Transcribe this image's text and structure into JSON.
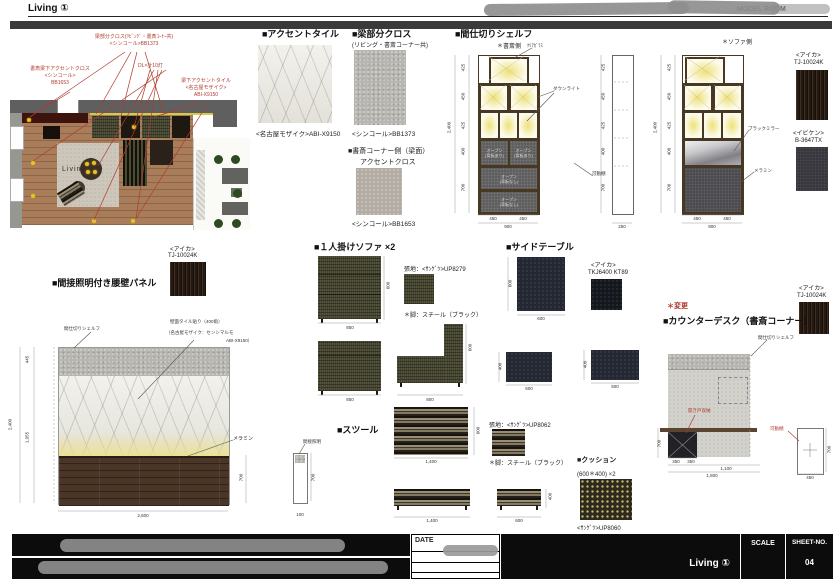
{
  "header": {
    "title": "Living ①",
    "redacted_text": "MODEL ROOM"
  },
  "plan": {
    "room": "Living",
    "ann_beam1": "梁部分クロス(ﾘﾋﾞﾝｸﾞ・書斎ｺｰﾅｰ共)",
    "ann_beam2": "<シンコール>BB1373",
    "ann_dl": "DL×計10灯",
    "ann_study1": "書斎梁下アクセントクロス",
    "ann_study2": "<シンコール>",
    "ann_study3": "BB1653",
    "ann_tile1": "梁下アクセントタイル",
    "ann_tile2": "<名古屋モザイク>",
    "ann_tile3": "ABI-X9150"
  },
  "samples": {
    "accent_tile_title": "■アクセントタイル",
    "accent_tile_caption": "<名古屋モザイク>ABI-X9150",
    "beam_title": "■梁部分クロス",
    "beam_subtitle": "(リビング・書斎コーナー共)",
    "beam_caption": "<シンコール>BB1373",
    "study_title1": "■書斎コーナー側（梁面）",
    "study_title2": "アクセントクロス",
    "study_caption": "<シンコール>BB1653"
  },
  "materials": {
    "aica": "<アイカ>",
    "aica_code": "TJ-10024K",
    "ibiken": "<イビケン>",
    "ibiken_code": "B-3647TX",
    "aica2_code": "TKJ6400 KT89",
    "sangetsu_sofa": "張地：<ｻﾝｹﾞﾂ>UP8279",
    "sangetsu_stool": "張地：<ｻﾝｹﾞﾂ>UP8062",
    "sangetsu_cushion": "<ｻﾝｹﾞﾂ>UP8060",
    "legs": "＊脚：スチール（ブラック）"
  },
  "shelf": {
    "title": "■間仕切りシェルフ",
    "study_side": "＊書斎側",
    "sofa_side": "＊ソファ側",
    "ann_glass": "ｸﾘｱｶﾞﾗｽ",
    "ann_downlight": "ダウンライト",
    "ann_movable": "可動棚",
    "ann_mirror": "ブラックミラー",
    "ann_melamine": "メラミン",
    "open": "オープン",
    "open_back": "(背板あり)",
    "open_noback": "(背板なし)",
    "h_total": "2,400",
    "h1": "425",
    "h2": "450",
    "h3": "425",
    "h4": "400",
    "h5": "700",
    "w1": "450",
    "w2": "450",
    "w_total": "900",
    "side_w": "250"
  },
  "panel": {
    "title": "■間接照明付き腰壁パネル",
    "ann_shelf": "間仕切りシェルフ",
    "ann_tile1": "壁面タイル貼り（400角）",
    "ann_tile2": "（名古屋モザイク：センシマルモ",
    "ann_tile3": "ABI-X9150）",
    "ann_melamine": "メラミン",
    "ann_light": "間接照明",
    "h_total": "2,400",
    "h_top": "445",
    "h_mid": "1,955",
    "h_wood": "700",
    "w": "2,600",
    "sect_w": "100",
    "sect_h": "700"
  },
  "sofa": {
    "title": "■１人掛けソファ ×2",
    "w": "850",
    "w_side": "800",
    "h": "600",
    "seat_h": "400"
  },
  "sidetable": {
    "title": "■サイドテーブル",
    "top_w": "600",
    "top_d": "600",
    "front_w": "600",
    "front_h": "400",
    "side_w": "500"
  },
  "stool": {
    "title": "■スツール",
    "w": "1,400",
    "d": "600",
    "h": "400"
  },
  "cushion": {
    "title": "■クッション",
    "size": "(600＊400) ×2"
  },
  "desk": {
    "change": "＊変更",
    "title": "■カウンターデスク（書斎コーナー）",
    "ann_shelf": "間仕切りシェルフ",
    "ann_cabinet": "開き戸収納",
    "ann_movable": "可動棚",
    "d1": "350",
    "d2": "350",
    "d3": "1,100",
    "total": "1,800",
    "h": "700",
    "side_w": "450",
    "side_h": "700"
  },
  "titleblock": {
    "date": "DATE",
    "project": "Living ①",
    "scale": "SCALE",
    "sheet": "SHEET-NO.",
    "sheet_no": "04"
  }
}
